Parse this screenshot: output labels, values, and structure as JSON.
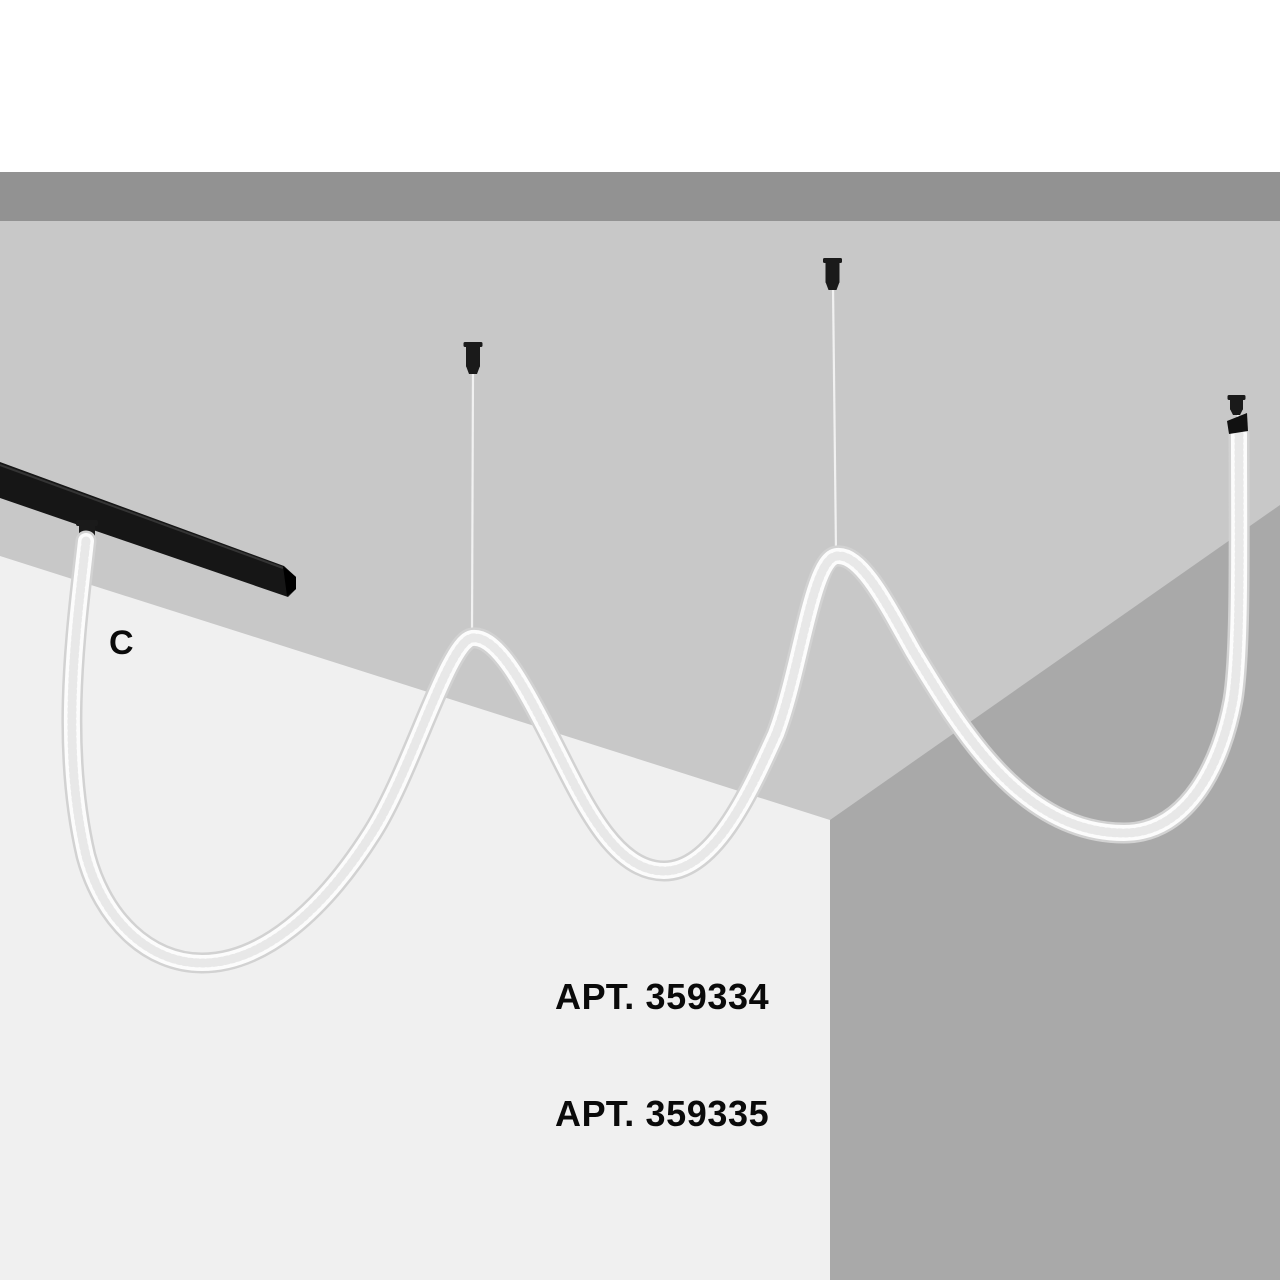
{
  "labels": {
    "marker_c": "C",
    "art_line_1": "АРТ. 359334",
    "art_line_2": "АРТ. 359335"
  },
  "colors": {
    "backdrop": "#ffffff",
    "upper_band": "#929292",
    "ceiling": "#c8c8c8",
    "left_wall": "#f0f0f0",
    "right_wall": "#a9a9a9",
    "track_rail": "#161616",
    "track_rail_end": "#000000",
    "mount_hardware": "#1a1a1a",
    "cord_outline": "#d2d2d2",
    "cord_body": "#fcfcfc",
    "cord_texture": "#e8e8e8",
    "suspension_wire": "#f1f1f1",
    "text": "#0a0a0a"
  }
}
